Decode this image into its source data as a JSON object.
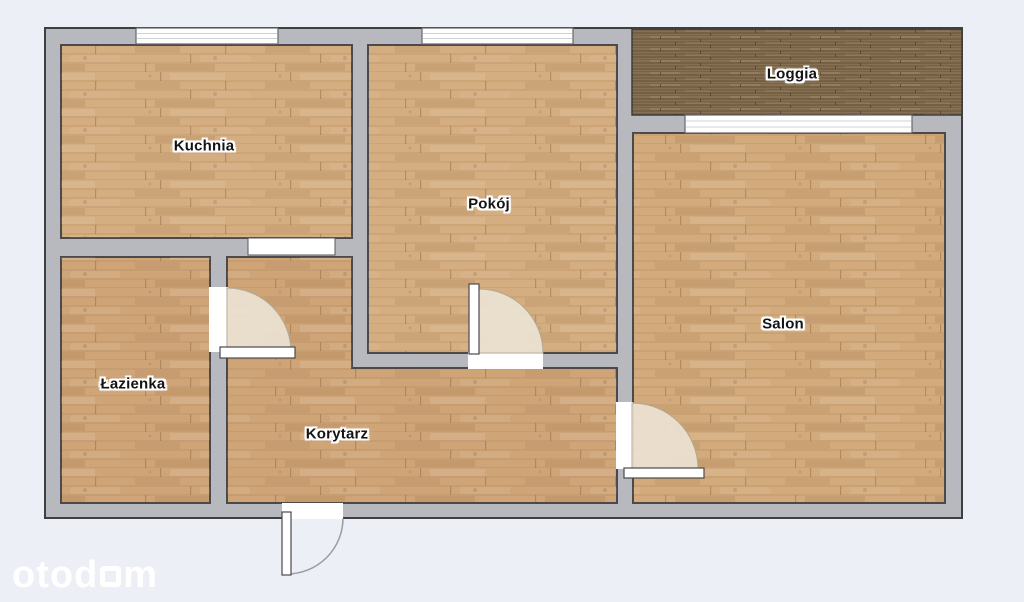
{
  "plan": {
    "rooms": {
      "kuchnia": {
        "label": "Kuchnia"
      },
      "pokoj": {
        "label": "Pokój"
      },
      "loggia": {
        "label": "Loggia"
      },
      "salon": {
        "label": "Salon"
      },
      "lazienka": {
        "label": "Łazienka"
      },
      "korytarz": {
        "label": "Korytarz"
      }
    }
  },
  "watermark": {
    "brand": "otodom",
    "pre": "otod",
    "post": "m"
  },
  "palette": {
    "background": "#edeff6",
    "wall_fill": "#b7b9be",
    "wall_outline": "#3f3f41",
    "floor_light": "#d4ad80",
    "floor_medium": "#d2aa7c",
    "floor_warm": "#cfa578",
    "loggia_wood": "#867051",
    "door_swing": "#ece2d2",
    "window_fill": "#ffffff",
    "label_color": "#141414",
    "watermark_color": "#ffffff"
  }
}
